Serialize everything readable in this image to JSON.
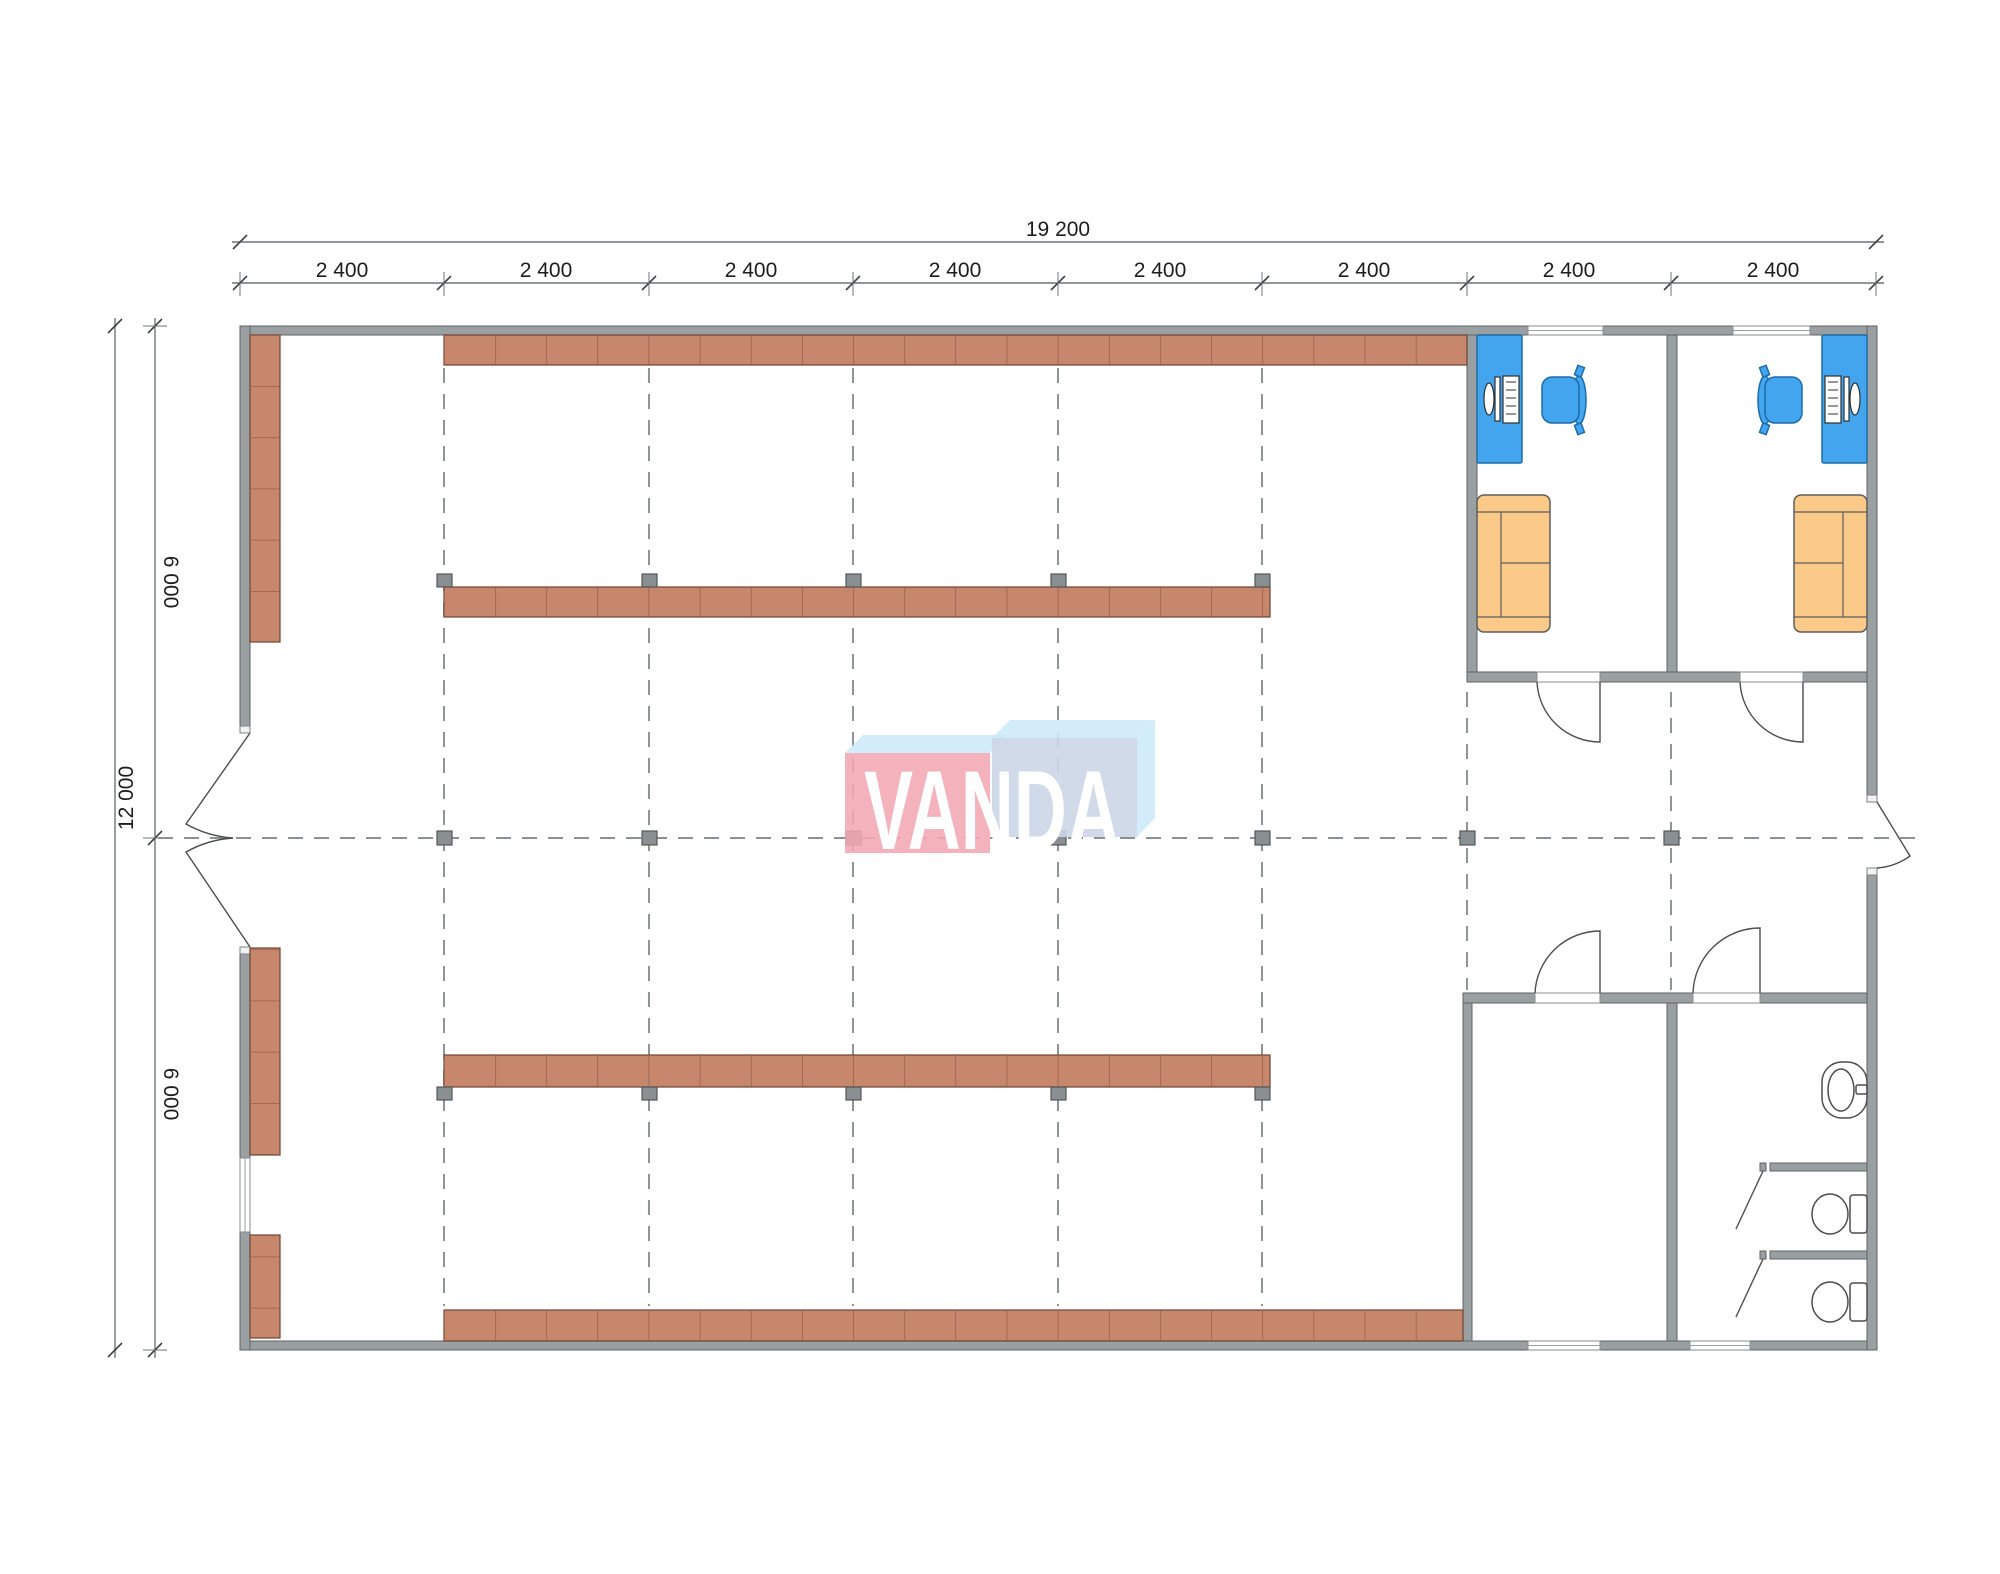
{
  "dimensions": {
    "overall_width_label": "19 200",
    "overall_height_label": "12 000",
    "top_segments": [
      "2 400",
      "2 400",
      "2 400",
      "2 400",
      "2 400",
      "2 400",
      "2 400",
      "2 400"
    ],
    "left_segments": [
      "6 000",
      "6 000"
    ]
  },
  "logo": {
    "text": "VANDA"
  },
  "colors": {
    "wall": "#9aa0a2",
    "shelf": "#c6876c",
    "shelf_line": "#8f5743",
    "square": "#8a8f91",
    "desk": "#42a5ee",
    "sofa": "#fbca88",
    "fixture_line": "#4d4d4d",
    "grid_line": "#7c8183",
    "dim_line": "#6f7476",
    "text": "#1d1d1d",
    "logo_pink": "#f2a7b3",
    "logo_panel_blue": "#ccd6e5",
    "logo_light_blue": "#cdeaf8",
    "logo_text": "#ffffff"
  }
}
